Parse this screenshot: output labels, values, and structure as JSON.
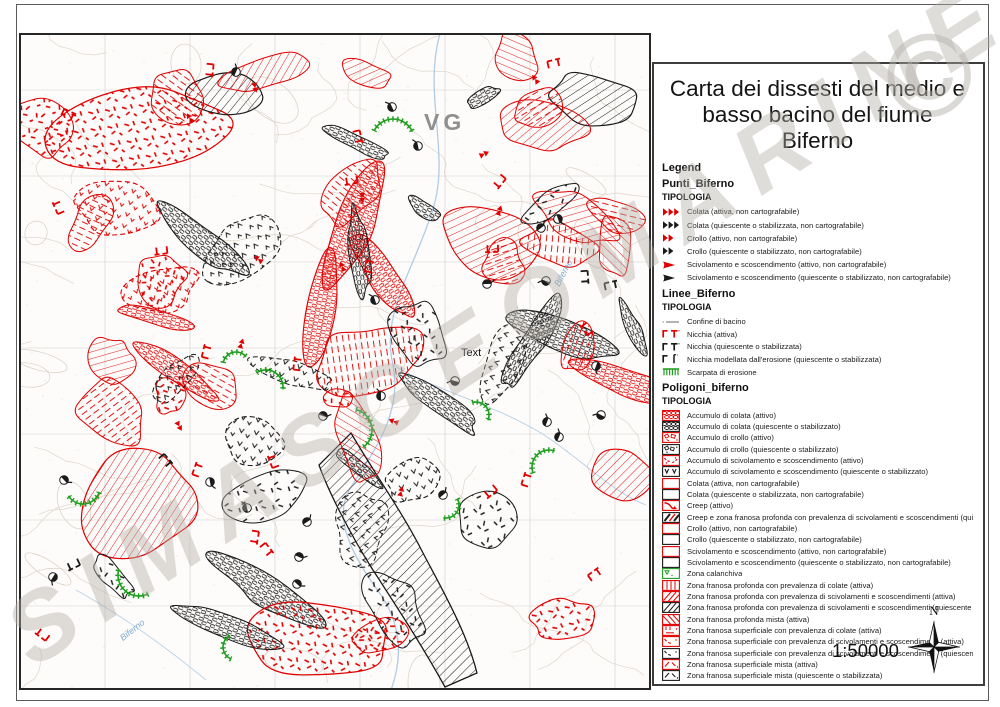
{
  "watermark": {
    "text": "SIMASGEOMARINE",
    "symbol": "©"
  },
  "map": {
    "labels": {
      "vg": "VG",
      "text": "Text",
      "river1": "Biferno",
      "river2": "Biferno"
    }
  },
  "legend": {
    "title": "Carta dei dissesti del medio e basso bacino del fiume Biferno",
    "header": "Legend",
    "scale": "1:50000",
    "north_label": "N",
    "sections": [
      {
        "name": "Punti_Biferno",
        "subheader": "TIPOLOGIA",
        "css": "sec-punti",
        "items": [
          {
            "symbol": "arrow3-red",
            "label": "Colata (attiva, non cartografabile)"
          },
          {
            "symbol": "arrow3-black",
            "label": "Colata (quiescente o stabilizzata, non cartografabile)"
          },
          {
            "symbol": "arrow2-red",
            "label": "Crollo (attivo, non cartografabile)"
          },
          {
            "symbol": "arrow2-black",
            "label": "Crollo (quiescente o stabilizzato, non cartografabile)"
          },
          {
            "symbol": "arrow1-red",
            "label": "Scivolamento e scoscendimento (attivo, non cartografabile)"
          },
          {
            "symbol": "arrow1-black",
            "label": "Scivolamento e scoscendimento (quiescente o stabilizzato, non cartografabile)"
          }
        ]
      },
      {
        "name": "Linee_Biferno",
        "subheader": "TIPOLOGIA",
        "css": "sec-linee",
        "items": [
          {
            "symbol": "line-confine",
            "label": "Confine di bacino"
          },
          {
            "symbol": "nicchia-red",
            "label": "Nicchia (attiva)"
          },
          {
            "symbol": "nicchia-black",
            "label": "Nicchia (quiescente o stabilizzata)"
          },
          {
            "symbol": "nicchia-erosione",
            "label": "Nicchia modellata dall'erosione (quiescente o stabilizzata)"
          },
          {
            "symbol": "scarpata-green",
            "label": "Scarpata di erosione"
          }
        ]
      },
      {
        "name": "Poligoni_biferno",
        "subheader": "TIPOLOGIA",
        "css": "sec-poligoni",
        "items": [
          {
            "symbol": "chain-red",
            "label": "Accumulo di colata (attivo)"
          },
          {
            "symbol": "chain-black",
            "label": "Accumulo di colata (quiescente o stabilizzato)"
          },
          {
            "symbol": "blocks-red",
            "label": "Accumulo di crollo (attivo)"
          },
          {
            "symbol": "blocks-black",
            "label": "Accumulo di crollo (quiescente o stabilizzato)"
          },
          {
            "symbol": "varc-red",
            "label": "Accumulo di scivolamento e scoscendimento (attivo)"
          },
          {
            "symbol": "vv-black",
            "label": "Accumulo di scivolamento e scoscendimento (quiescente o stabilizzato)"
          },
          {
            "symbol": "rect-red",
            "label": "Colata (attiva, non cartografabile)"
          },
          {
            "symbol": "rect-black",
            "label": "Colata (quiescente o stabilizzata, non cartografabile)"
          },
          {
            "symbol": "creep-red",
            "label": "Creep (attivo)"
          },
          {
            "symbol": "creep-mix",
            "label": "Creep e zona franosa profonda con prevalenza di scivolamenti e scoscendimenti (quiescente o stabilizzato)"
          },
          {
            "symbol": "rect-red",
            "label": "Crollo (attivo, non cartografabile)"
          },
          {
            "symbol": "rect-black",
            "label": "Crollo (quiescente o stabilizzato, non cartografabile)"
          },
          {
            "symbol": "rect-red",
            "label": "Scivolamento e scoscendimento (attivo, non cartografabile)"
          },
          {
            "symbol": "rect-black",
            "label": "Scivolamento e scoscendimento (quiescente o stabilizzato, non cartografabile)"
          },
          {
            "symbol": "calanchiva-green",
            "label": "Zona calanchiva"
          },
          {
            "symbol": "vbars-red",
            "label": "Zona franosa profonda con prevalenza di colate (attiva)"
          },
          {
            "symbol": "diag-red",
            "label": "Zona franosa profonda con prevalenza di scivolamenti e scoscendimenti (attiva)"
          },
          {
            "symbol": "diag-black",
            "label": "Zona franosa profonda con prevalenza di scivolamenti e scoscendimenti (quiescente o stabilizzata)"
          },
          {
            "symbol": "bdiag-red",
            "label": "Zona franosa profonda mista (attiva)"
          },
          {
            "symbol": "supcol-red",
            "label": "Zona franosa superficiale con prevalenza di colate (attiva)"
          },
          {
            "symbol": "supsciv-red",
            "label": "Zona franosa superficiale con prevalenza di scivolamenti e scoscendimenti (attiva)"
          },
          {
            "symbol": "supsciv-black",
            "label": "Zona franosa superficiale con prevalenza di scivolamenti e scoscendimenti (quiescente o stabilizzata)"
          },
          {
            "symbol": "supmista-red",
            "label": "Zona franosa superficiale mista (attiva)"
          },
          {
            "symbol": "supmista-black",
            "label": "Zona franosa superficiale mista (quiescente o stabilizzata)"
          }
        ]
      }
    ]
  },
  "colors": {
    "active_red": "#e00000",
    "quiescent_black": "#1a1a1a",
    "erosion_green": "#1e9e1e",
    "watermark_gray": "#b2ada7",
    "contour_tan": "#d9cfc3",
    "grid_gray": "#cfcfcf",
    "river_blue": "#a9c7e2",
    "map_label_gray": "#8f8f8f"
  }
}
